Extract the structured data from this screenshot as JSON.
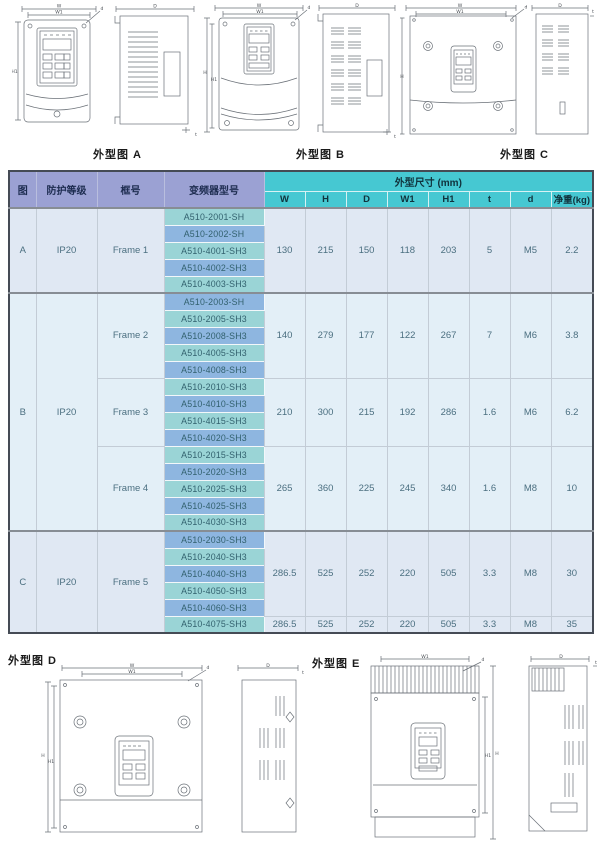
{
  "colors": {
    "header_left_bg": "#9ba1d3",
    "header_dims_bg": "#46c8d2",
    "model_teal_bg": "#9ad4d6",
    "model_blue_bg": "#8eb6e0",
    "section_light_bg": "#e0e8f3",
    "body_text": "#4b6f80"
  },
  "figures": {
    "dim_labels": {
      "w": "W",
      "w1": "W1",
      "h": "H",
      "h1": "H1",
      "depth": "D",
      "t": "t",
      "screw": "d"
    },
    "top": [
      {
        "label": "外型图 A"
      },
      {
        "label": "外型图 B"
      },
      {
        "label": "外型图 C"
      }
    ],
    "bottom": [
      {
        "label": "外型图 D"
      },
      {
        "label": "外型图 E"
      }
    ]
  },
  "table": {
    "col_headers": {
      "fig": "图",
      "protection": "防护等级",
      "frame": "框号",
      "model": "变频器型号",
      "dims_group": "外型尺寸 (mm)"
    },
    "dim_headers": [
      "W",
      "H",
      "D",
      "W1",
      "H1",
      "t",
      "d",
      "净重(kg)"
    ],
    "sections": [
      {
        "fig": "A",
        "protection": "IP20",
        "bg": "a",
        "frames": [
          {
            "name": "Frame 1",
            "models": [
              "A510-2001-SH",
              "A510-2002-SH",
              "A510-4001-SH3",
              "A510-4002-SH3",
              "A510-4003-SH3"
            ],
            "dim_spans": [
              {
                "rows": 5,
                "values": [
                  "130",
                  "215",
                  "150",
                  "118",
                  "203",
                  "5",
                  "M5",
                  "2.2"
                ]
              }
            ]
          }
        ]
      },
      {
        "fig": "B",
        "protection": "IP20",
        "bg": "b",
        "frames": [
          {
            "name": "Frame 2",
            "models": [
              "A510-2003-SH",
              "A510-2005-SH3",
              "A510-2008-SH3",
              "A510-4005-SH3",
              "A510-4008-SH3"
            ],
            "dim_spans": [
              {
                "rows": 5,
                "values": [
                  "140",
                  "279",
                  "177",
                  "122",
                  "267",
                  "7",
                  "M6",
                  "3.8"
                ]
              }
            ]
          },
          {
            "name": "Frame 3",
            "models": [
              "A510-2010-SH3",
              "A510-4010-SH3",
              "A510-4015-SH3",
              "A510-4020-SH3"
            ],
            "dim_spans": [
              {
                "rows": 4,
                "values": [
                  "210",
                  "300",
                  "215",
                  "192",
                  "286",
                  "1.6",
                  "M6",
                  "6.2"
                ]
              }
            ]
          },
          {
            "name": "Frame 4",
            "models": [
              "A510-2015-SH3",
              "A510-2020-SH3",
              "A510-2025-SH3",
              "A510-4025-SH3",
              "A510-4030-SH3"
            ],
            "dim_spans": [
              {
                "rows": 5,
                "values": [
                  "265",
                  "360",
                  "225",
                  "245",
                  "340",
                  "1.6",
                  "M8",
                  "10"
                ]
              }
            ]
          }
        ]
      },
      {
        "fig": "C",
        "protection": "IP20",
        "bg": "a",
        "frames": [
          {
            "name": "Frame 5",
            "models": [
              "A510-2030-SH3",
              "A510-2040-SH3",
              "A510-4040-SH3",
              "A510-4050-SH3",
              "A510-4060-SH3",
              "A510-4075-SH3"
            ],
            "dim_spans": [
              {
                "rows": 5,
                "values": [
                  "286.5",
                  "525",
                  "252",
                  "220",
                  "505",
                  "3.3",
                  "M8",
                  "30"
                ]
              },
              {
                "rows": 1,
                "values": [
                  "286.5",
                  "525",
                  "252",
                  "220",
                  "505",
                  "3.3",
                  "M8",
                  "35"
                ]
              }
            ]
          }
        ]
      }
    ]
  }
}
